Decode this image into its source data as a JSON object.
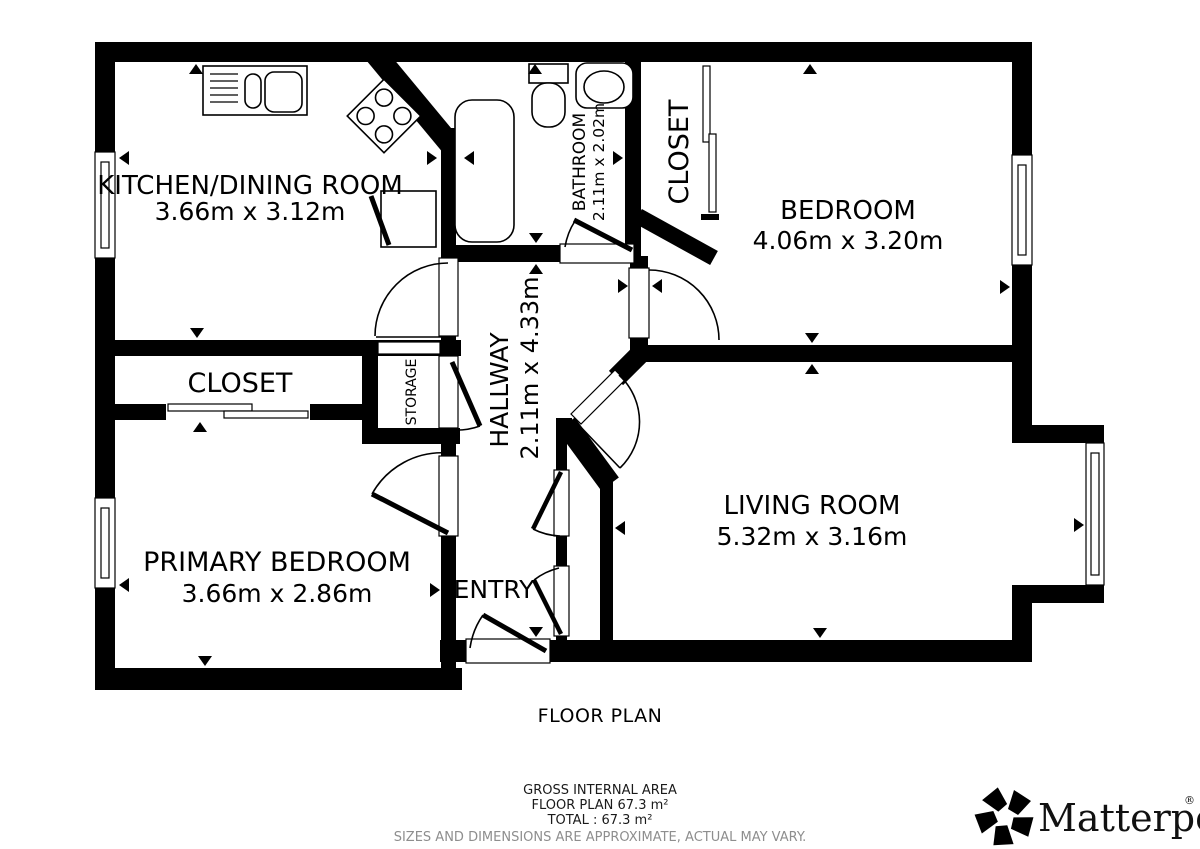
{
  "plan": {
    "title": "FLOOR PLAN",
    "rooms": {
      "kitchen": {
        "name": "KITCHEN/DINING ROOM",
        "dims": "3.66m x 3.12m"
      },
      "bathroom": {
        "name": "BATHROOM",
        "dims": "2.11m x 2.02m"
      },
      "closet_top": {
        "name": "CLOSET"
      },
      "bedroom": {
        "name": "BEDROOM",
        "dims": "4.06m x 3.20m"
      },
      "hallway": {
        "name": "HALLWAY",
        "dims": "2.11m x 4.33m"
      },
      "closet_left": {
        "name": "CLOSET"
      },
      "storage": {
        "name": "STORAGE"
      },
      "primary_bedroom": {
        "name": "PRIMARY BEDROOM",
        "dims": "3.66m x 2.86m"
      },
      "living_room": {
        "name": "LIVING ROOM",
        "dims": "5.32m x 3.16m"
      },
      "entry": {
        "name": "ENTRY"
      }
    }
  },
  "footer": {
    "area_heading": "GROSS INTERNAL AREA",
    "area_floor": "FLOOR PLAN 67.3 m²",
    "area_total": "TOTAL :  67.3 m²",
    "disclaimer": "SIZES AND DIMENSIONS ARE APPROXIMATE, ACTUAL MAY VARY."
  },
  "brand": {
    "name": "Matterport",
    "registered": "®"
  },
  "colors": {
    "ink": "#000000",
    "background": "#ffffff",
    "disclaimer_gray": "#8e8e8e"
  }
}
